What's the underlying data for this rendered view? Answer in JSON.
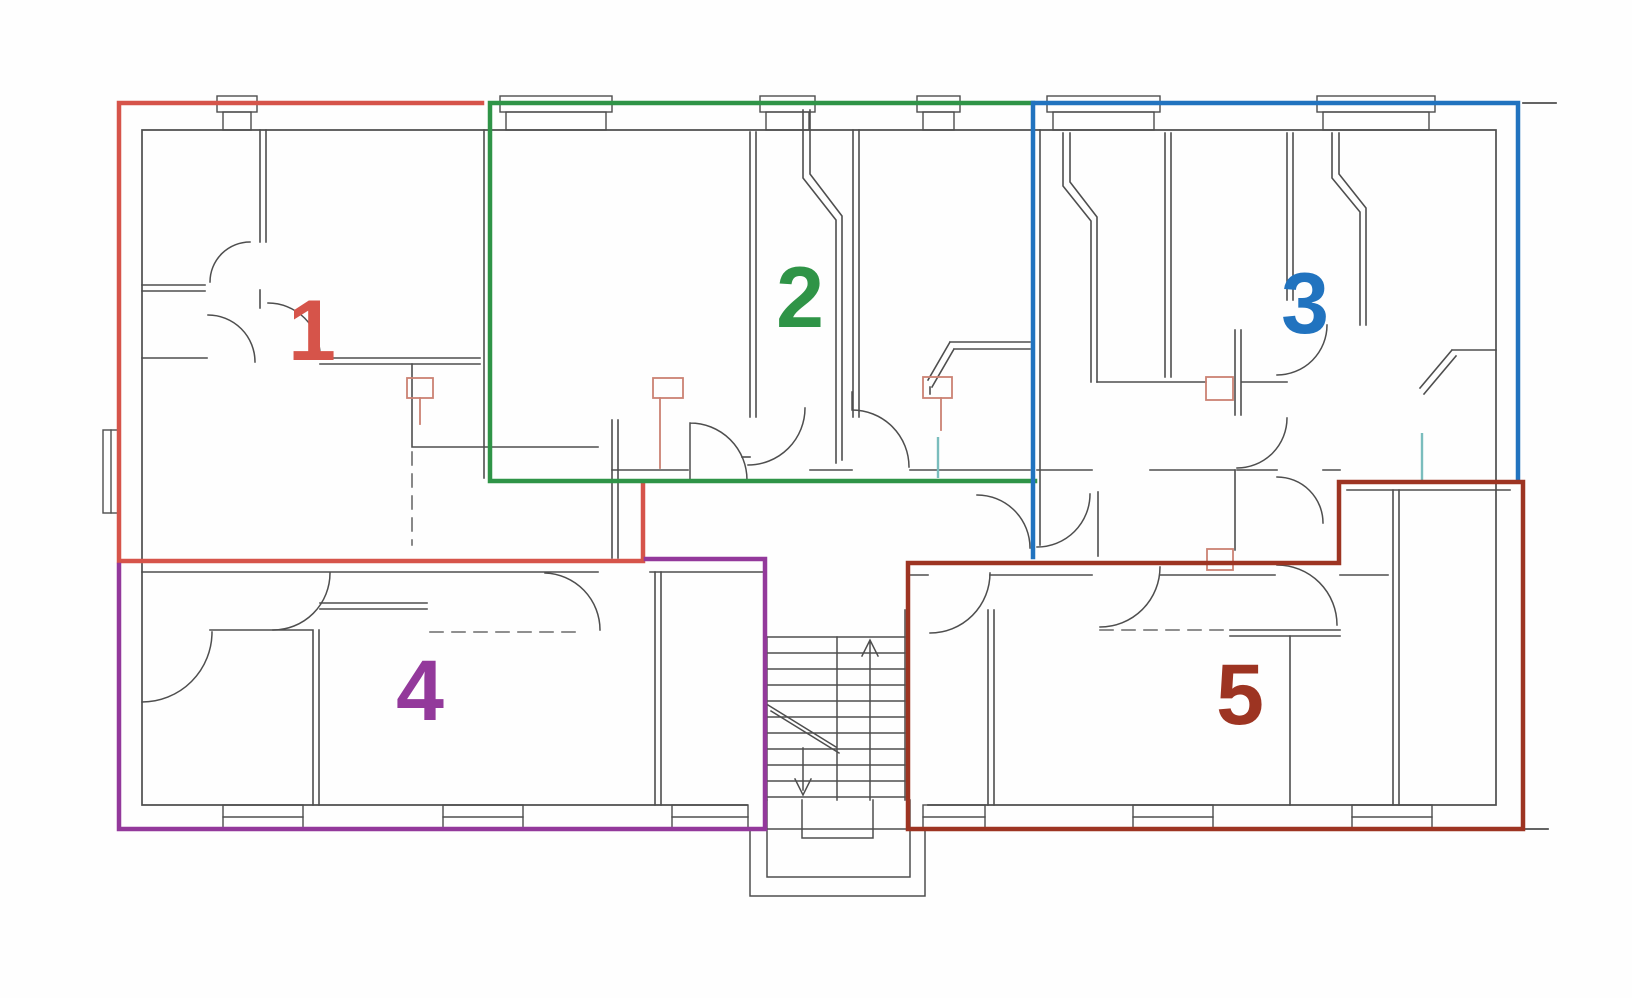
{
  "document": {
    "kind": "apartment-floor-plan",
    "background": "#fefefe"
  },
  "units": [
    {
      "id": 1,
      "label": "1",
      "color": "#d6544a",
      "position": "top-left"
    },
    {
      "id": 2,
      "label": "2",
      "color": "#2f9447",
      "position": "top-middle"
    },
    {
      "id": 3,
      "label": "3",
      "color": "#2173bf",
      "position": "top-right"
    },
    {
      "id": 4,
      "label": "4",
      "color": "#93399b",
      "position": "bottom-left"
    },
    {
      "id": 5,
      "label": "5",
      "color": "#9d3422",
      "position": "bottom-right"
    }
  ],
  "palette": {
    "wall": "#4e4e4e",
    "wall_light": "#6a6a6a",
    "chimney": "#cb8273",
    "glass": "#7abdbd",
    "paper": "#fefefe"
  },
  "stairs": {
    "up_arrow": "up",
    "down_arrow": "down",
    "treads": 11
  }
}
